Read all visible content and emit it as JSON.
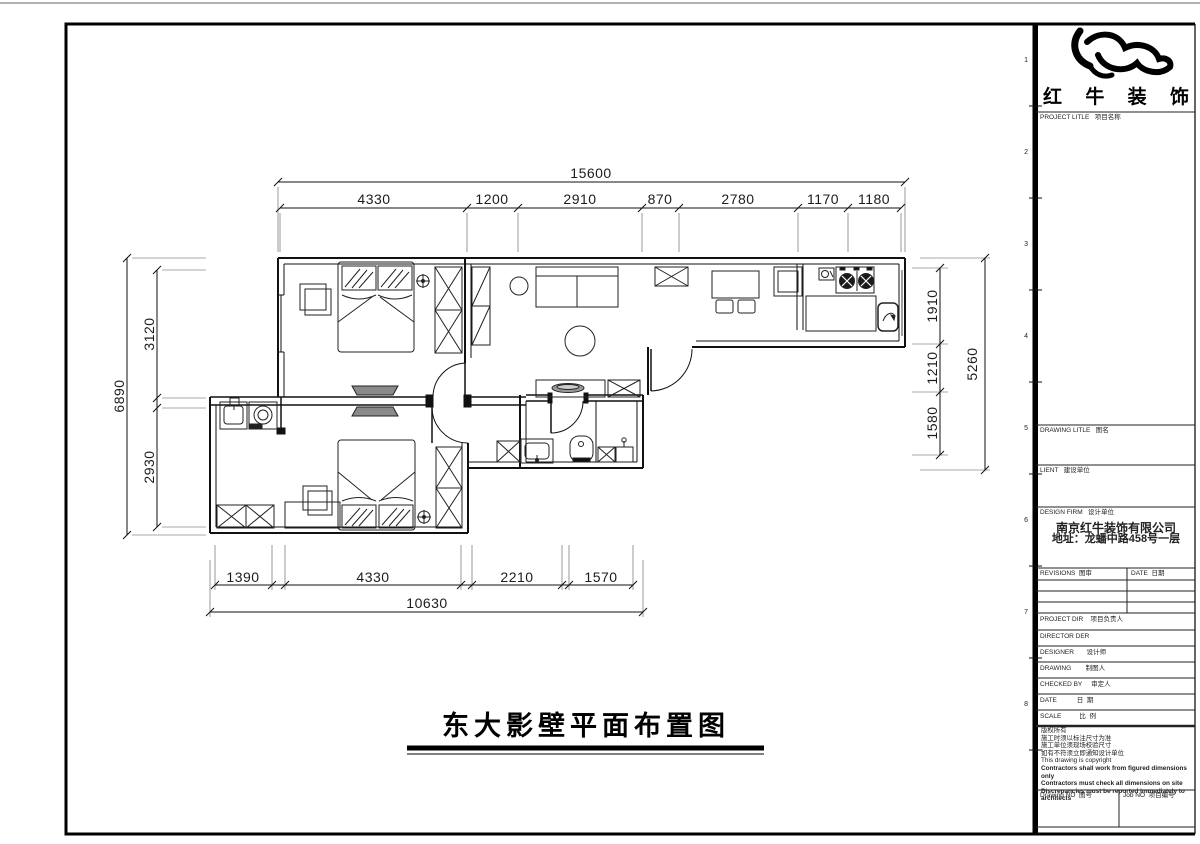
{
  "title": "东大影壁平面布置图",
  "dims": {
    "top_total": "15600",
    "top": [
      "4330",
      "1200",
      "2910",
      "870",
      "2780",
      "1170",
      "1180"
    ],
    "left_total": "6890",
    "left": [
      "3120",
      "2930"
    ],
    "right_total": "5260",
    "right": [
      "1910",
      "1210",
      "1580"
    ],
    "bottom_total": "10630",
    "bottom": [
      "1390",
      "4330",
      "2210",
      "1570"
    ]
  },
  "titleblock": {
    "logo": [
      "红",
      "牛",
      "装",
      "饰"
    ],
    "project_title": "PROJECT LITLE   项目名称",
    "drawing_title": "DRAWING LITLE   图名",
    "client": "LIENT   建设单位",
    "design_firm": "DESIGN FIRM   设计单位",
    "firm_name": "南京红牛装饰有限公司",
    "firm_address": "地址：龙蟠中路458号一层",
    "revisions": "REVISIONS  图审",
    "rev_date": "DATE  日期",
    "project_dir": "PROJECT DIR    项目负责人",
    "director": "DIRECTOR DER",
    "designer": "DESIGNER       设计师",
    "drawing": "DRAWING        制图人",
    "checked_by": "CHECKED BY     审定人",
    "date": "DATE           日  期",
    "scale": "SCALE          比  例",
    "notes": [
      "版权所有",
      "施工时须以标注尺寸为准",
      "施工单位须现场校验尺寸",
      "如有不符须立即通知设计单位",
      "This drawing is copyright",
      "Contractors shall work from figured dimensions only",
      "Contractors must check all dimensions on site",
      "Discrepancies must be reported immediately to architects"
    ],
    "drawing_no": "Drawing NO  图号",
    "job_no": "Job NO  项目编号"
  },
  "ruler": [
    "1",
    "2",
    "3",
    "4",
    "5",
    "6",
    "7",
    "8"
  ]
}
